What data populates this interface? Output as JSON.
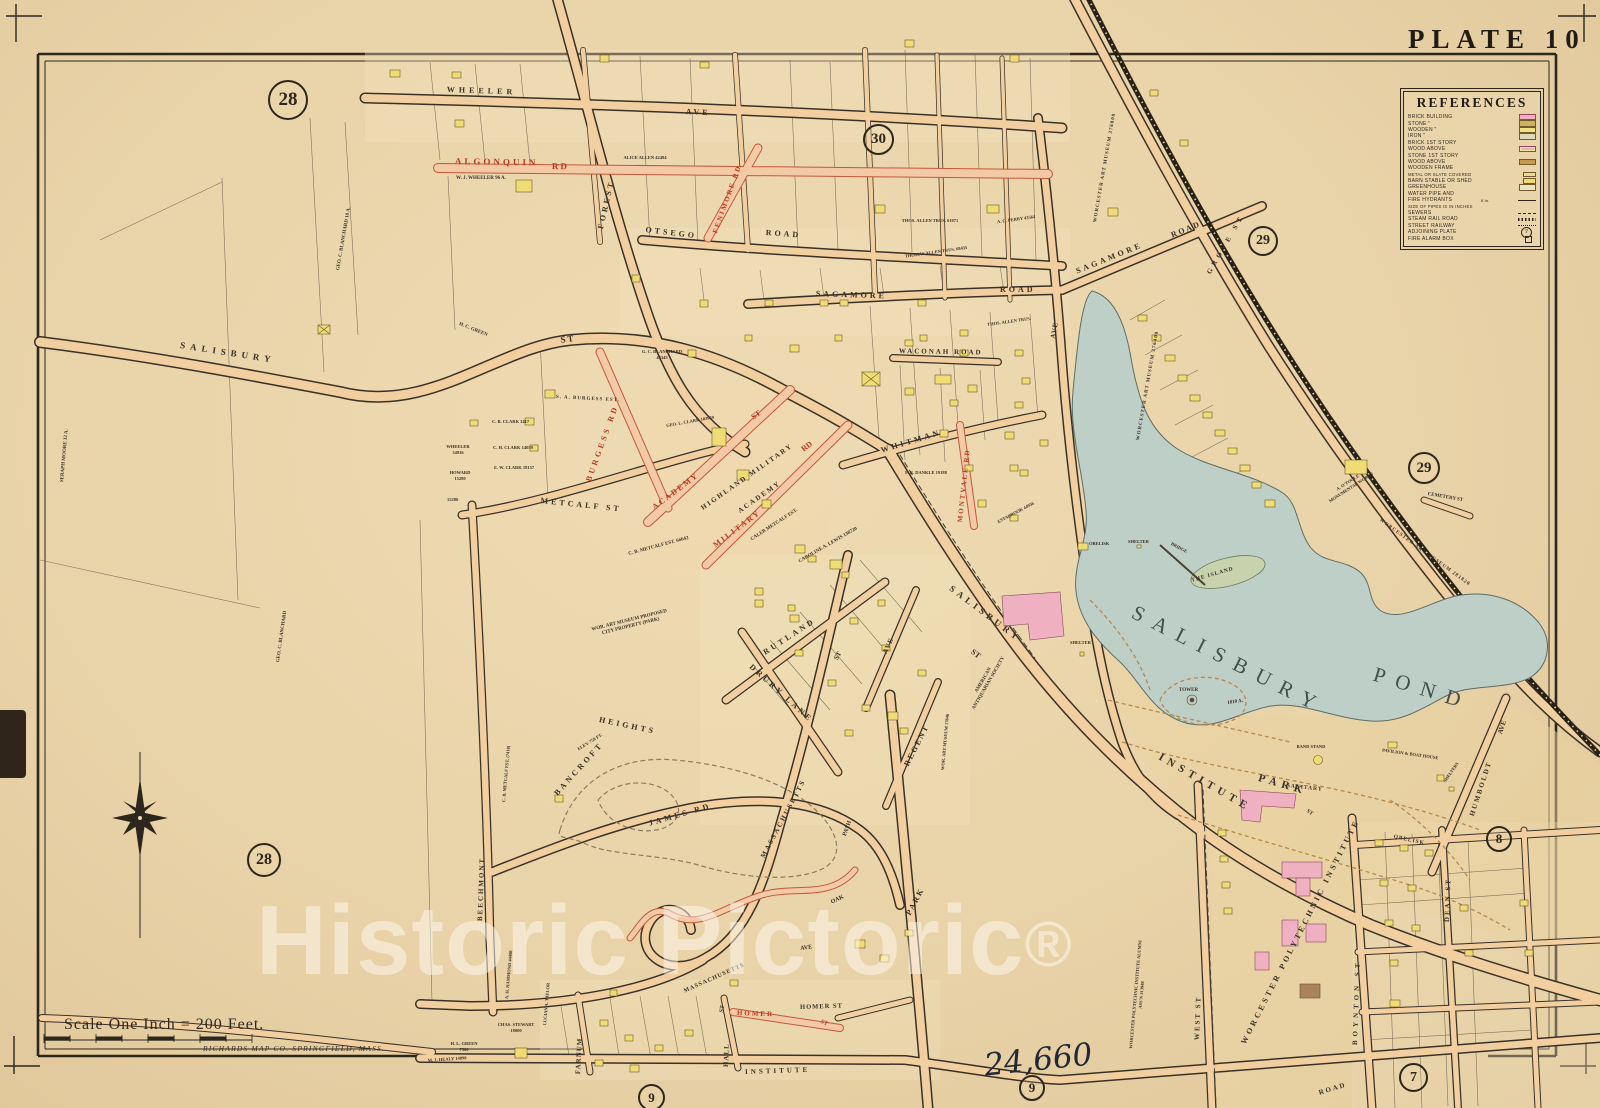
{
  "plate": {
    "title": "PLATE 10"
  },
  "legend": {
    "title": "REFERENCES",
    "entries": [
      {
        "label": "BRICK BUILDING",
        "symbol": "brick"
      },
      {
        "label": "STONE \"",
        "symbol": "stone"
      },
      {
        "label": "WOODEN \"",
        "symbol": "wood"
      },
      {
        "label": "IRON \"",
        "symbol": "iron"
      },
      {
        "label": "BRICK 1ST STORY",
        "symbol": "none"
      },
      {
        "label": "WOOD ABOVE",
        "symbol": "brickwood"
      },
      {
        "label": "STONE 1ST STORY",
        "symbol": "none"
      },
      {
        "label": "WOOD ABOVE",
        "symbol": "stonewood"
      },
      {
        "label": "WOODEN FRAME",
        "symbol": "none"
      },
      {
        "label": "METAL OR SLATE COVERED",
        "symbol": "metal"
      },
      {
        "label": "BARN STABLE OR SHED",
        "symbol": "barn"
      },
      {
        "label": "GREENHOUSE",
        "symbol": "green"
      },
      {
        "label": "WATER PIPE AND",
        "symbol": "none"
      },
      {
        "label": "FIRE HYDRANTS",
        "symbol": "line",
        "note": "6 in."
      },
      {
        "label": "SIZE OF PIPES IS IN INCHES",
        "symbol": "none"
      },
      {
        "label": "SEWERS",
        "symbol": "sewer"
      },
      {
        "label": "STEAM RAIL ROAD",
        "symbol": "rr"
      },
      {
        "label": "STREET RAILWAY",
        "symbol": "railway"
      },
      {
        "label": "ADJOINING PLATE",
        "symbol": "plate",
        "note": "7"
      },
      {
        "label": "FIRE ALARM BOX",
        "symbol": "fire"
      }
    ]
  },
  "scale": {
    "label": "Scale One Inch = 200 Feet.",
    "credit": "RICHARDS MAP CO.  SPRINGFIELD, MASS."
  },
  "watermark": {
    "text": "Historic Pictoric",
    "symbol": "®"
  },
  "handwriting": {
    "text": "24,660"
  },
  "plate_circles": {
    "nw": "28",
    "n": "30",
    "ne": "29",
    "e": "29",
    "se": "8",
    "w": "28",
    "s1": "9",
    "s2": "9",
    "br": "7"
  },
  "labels": {
    "wheeler": "WHEELER",
    "wheeler_ave": "AVE",
    "algonquin": "ALGONQUIN",
    "algonquin_rd": "RD",
    "fenimore_rd": "FENIMORE RD",
    "otsego": "OTSEGO",
    "otsego_road": "ROAD",
    "sagamore_w": "SAGAMORE",
    "sagamore_w_road": "ROAD",
    "sagamore_e": "SAGAMORE",
    "sagamore_e_road": "ROAD",
    "salisbury_w": "SALISBURY",
    "salisbury_w_st": "ST",
    "forest": "FOREST",
    "waconah": "WACONAH ROAD",
    "whitman": "WHITMAN",
    "montvale_rd": "MONTVALE RD",
    "metcalf": "METCALF  ST",
    "burgess_rd": "BURGESS  RD",
    "academy": "ACADEMY",
    "academy_st": "ST",
    "military": "MILITARY",
    "military_rd": "RD",
    "salisbury_se": "SALISBURY",
    "salisbury_se_st": "ST",
    "james_rd": "JAMES  RD",
    "drury_lane": "DRURY  LANE",
    "rutland": "RUTLAND",
    "rutland_st": "ST",
    "regent": "REGENT",
    "ave_small": "AVE",
    "ave_museum": "AVE",
    "massachusetts_curve": "MASSACHUSETTS",
    "massachusetts_ave": "AVE",
    "massachusetts_diag": "MASSACHUSETTS",
    "beechmont": "BEECHMONT",
    "farnum": "FARNUM",
    "hall": "HALL",
    "hall_st": "ST",
    "homer_red": "HOMER",
    "homer_red_st": "ST",
    "homer_black": "HOMER ST",
    "institute_w": "INSTITUTE",
    "institute_e": "ROAD",
    "park_ave": "PARK",
    "oak": "OAK",
    "path": "PATH",
    "west_st": "WEST  ST",
    "boynton_st": "BOYNTON  ST",
    "dean_st": "DEAN  ST",
    "humboldt": "HUMBOLDT",
    "humboldt_ave": "AVE",
    "grove_st": "GROVE  ST",
    "cemetery_st": "CEMETERY ST",
    "sanitary": "SANITARY",
    "sanitary_st": "ST",
    "obelisk_park": "OBELISK",
    "obelisk_bridge": "OBELISK",
    "shelter_bridge": "SHELTER",
    "bridge": "BRIDGE",
    "the_island": "THE ISLAND",
    "shelter_w": "SHELTER",
    "shelters_e": "SHELTERS",
    "tower": "TOWER",
    "tower_acres": "1810 A.",
    "band_stand": "BAND STAND",
    "pavilion": "PAVILION & BOAT HOUSE",
    "institute_park_1": "INSTITUTE",
    "institute_park_2": "PARK",
    "pond_1": "SALISBURY",
    "pond_2": "POND",
    "bancroft_1": "BANCROFT",
    "bancroft_2": "HEIGHTS",
    "bancroft_elev": "ELEV. 750 FT.",
    "wor_proposed": "WOR. ART MUSEUM PROPOSED CITY PROPERTY (PARK)",
    "wam_ne": "WORCESTER ART MUSEUM 376800",
    "wam_w": "WORCESTER ART MUSEUM 376400",
    "wam_se": "WORCESTER ART MUSEUM 281820",
    "wam_s": "WOR. ART MUSEUM 17846",
    "wpi": "WORCESTER POLYTECHNIC INSTITUTE",
    "wpi_alumni": "WORCESTER POLYTECHNIC INSTITUTE ALUMNI ASS'N 313948",
    "otoole": "A. O'TOOLE MONUMENTAL WORKS",
    "antiquarian": "AMERICAN ANTIQUARIAN SOCIETY",
    "seraph_moore": "SERAPH MOORE 12 A.",
    "blanchard_n": "GEO. C. BLANCHARD 10 A.",
    "blanchard_s": "GEO. C. BLANCHARD",
    "wj_wheeler": "W. J. WHEELER 96 A.",
    "hc_green": "H. C. GREEN",
    "alice_allen": "ALICE ALLEN 42494",
    "thos_allen_n": "THOS. ALLEN TRUS. 61871",
    "thomas_allen": "THOMAS ALLEN TRUS. 68435",
    "thos_allen_e": "THOS. ALLEN TRUS.",
    "ac_perry": "A. C. PERRY 43564",
    "sa_burgess": "S. A. BURGESS EST.",
    "gc_blanchard": "G. C. BLANCHARD 44345",
    "geo_clark": "GEO. L. CLARK 103959",
    "highland_1": "HIGHLAND MILITARY",
    "highland_2": "ACADEMY",
    "caleb_metcalf": "CALEB METCALF EST.",
    "caroline_lewis": "CAROLINE A. LEWIS 138720",
    "cb_metcalf": "C. B. METCALF EST. 66642",
    "cb_metcalf2": "C. B. METCALF EST. (7418)",
    "cb_clark": "C. B. CLARK 3417",
    "ch_clark": "C. H. CLARK 14059",
    "ew_clark": "E. W. CLARK 18157",
    "wheeler_lot": "WHEELER 34936",
    "howard_lot": "HOWARD 15280",
    "lot_15280": "15280",
    "estabrook": "ESTABROOK 44956",
    "fr_dankle": "F. R. DANKLE 19188",
    "mj_healy": "M. J. HEALY 14898",
    "hl_green": "H. L. GREEN 7500",
    "chas_stewart": "CHAS. STEWART 18000",
    "lucian_taylor": "LUCIAN A. TAYLOR",
    "ah_hammond": "A. H. HAMMOND 44498"
  }
}
